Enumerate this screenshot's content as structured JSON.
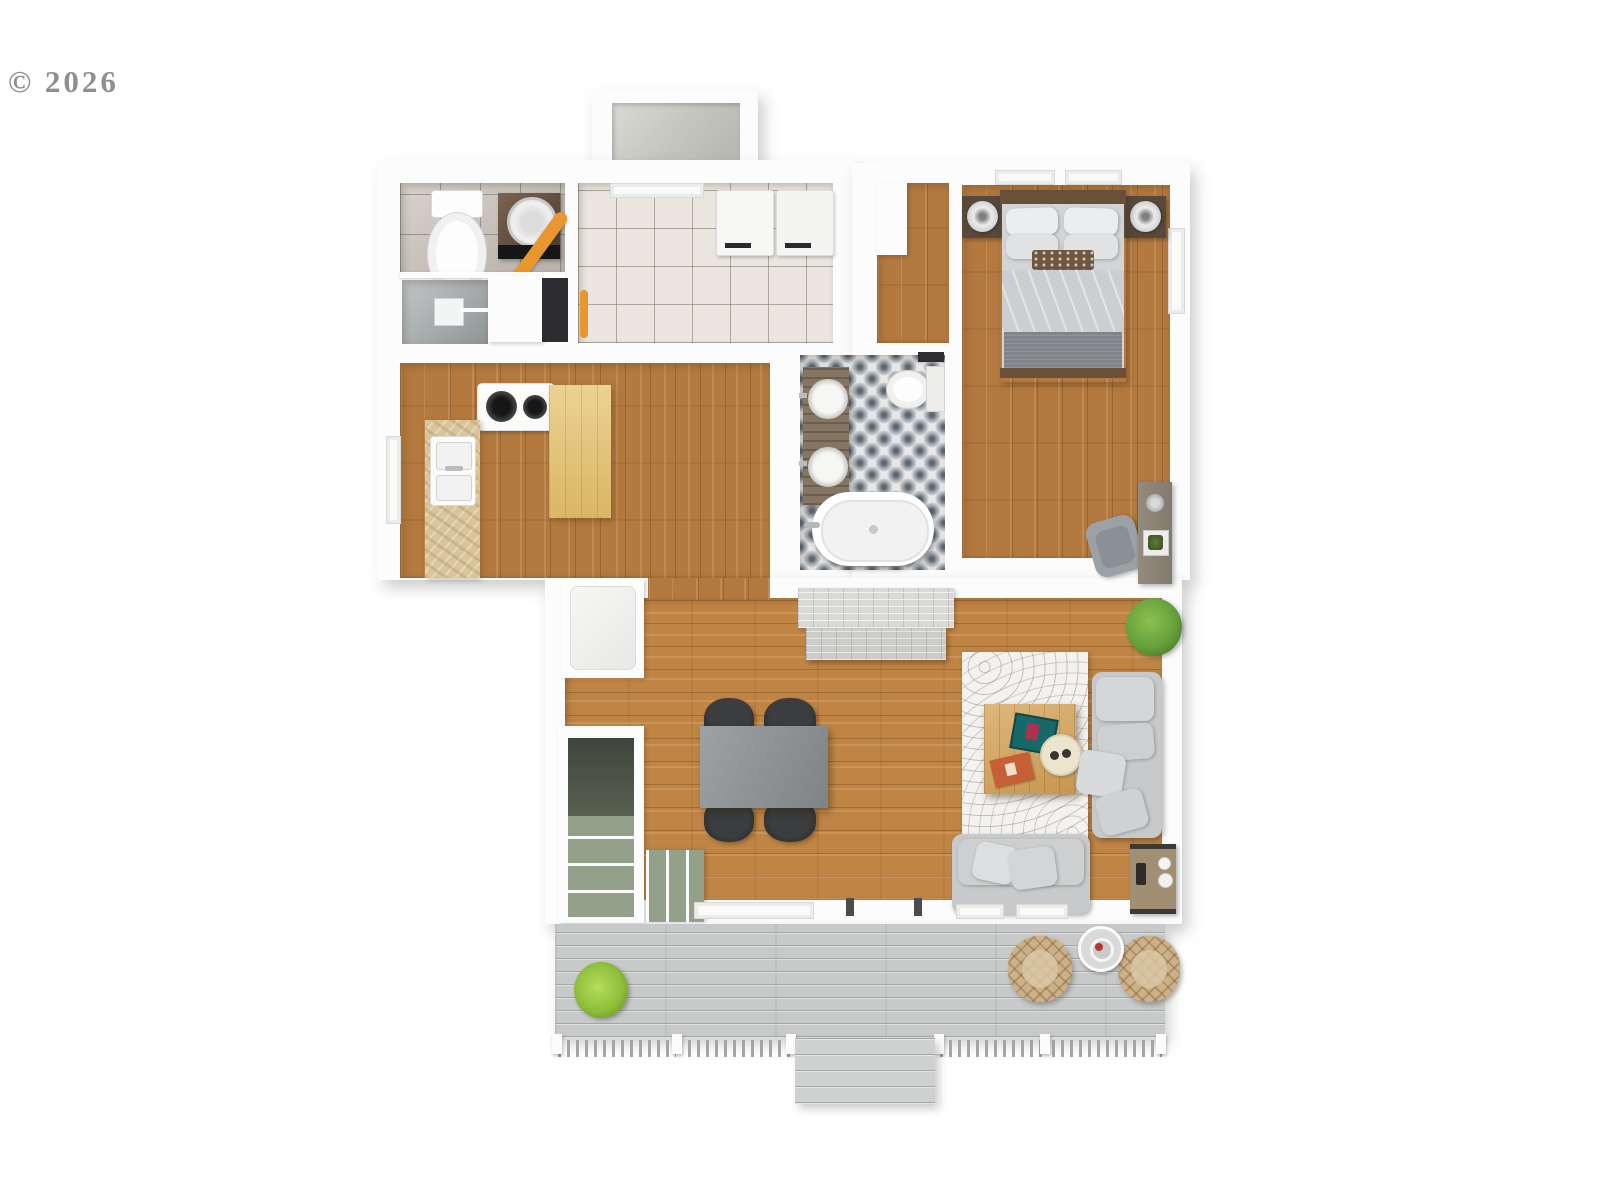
{
  "watermark": {
    "text": "© 2026"
  },
  "scene": {
    "type": "3d-floor-plan-top-view",
    "rooms": [
      "entry-closet",
      "small-bathroom",
      "laundry-room",
      "kitchen",
      "hallway",
      "bedroom",
      "main-bathroom",
      "living-dining-room",
      "staircase",
      "deck"
    ],
    "furniture": [
      "toilet",
      "washing-machine",
      "ironing-board",
      "shower",
      "laundry-appliances",
      "stove",
      "kitchen-sink",
      "island-counter",
      "stone-counter",
      "refrigerator",
      "closet",
      "bed",
      "nightstands",
      "table-lamps",
      "desk",
      "desk-chair",
      "vanity-double-sink",
      "toilet",
      "bathtub",
      "fireplace",
      "dining-table",
      "dining-chairs",
      "area-rug",
      "coffee-table",
      "books",
      "tray",
      "sofa",
      "loveseat",
      "side-table",
      "plants",
      "wicker-chairs",
      "patio-table",
      "deck-railing",
      "deck-steps"
    ]
  },
  "colors": {
    "wall": "#fcfcfc",
    "wood_kitchen": "#b3793f",
    "wood_living": "#c08545",
    "tile_white": "#ebe7e0",
    "tile_gray": "#c6bfb6",
    "tile_pattern_base": "#e7e9ea",
    "tile_pattern_ink": "#5e6770",
    "deck_plank": "#c8cac9",
    "deck_line": "#a4a6a5",
    "stair_green": "#93a18b",
    "stair_dark": "#4c5248",
    "sofa_gray": "#c7c9ca",
    "rug_white": "#f3f2ef",
    "table_gray": "#8d9296",
    "chair_black": "#2c2e2f",
    "counter_light": "#e5c36f",
    "counter_stone": "#d9c59c",
    "wood_dark": "#6a5038",
    "plant_green": "#66a03c",
    "plant_lime": "#8fbf3a",
    "wicker_tan": "#cdb189",
    "accent_orange": "#e8962e",
    "fireplace_gray": "#d9d9d7"
  }
}
